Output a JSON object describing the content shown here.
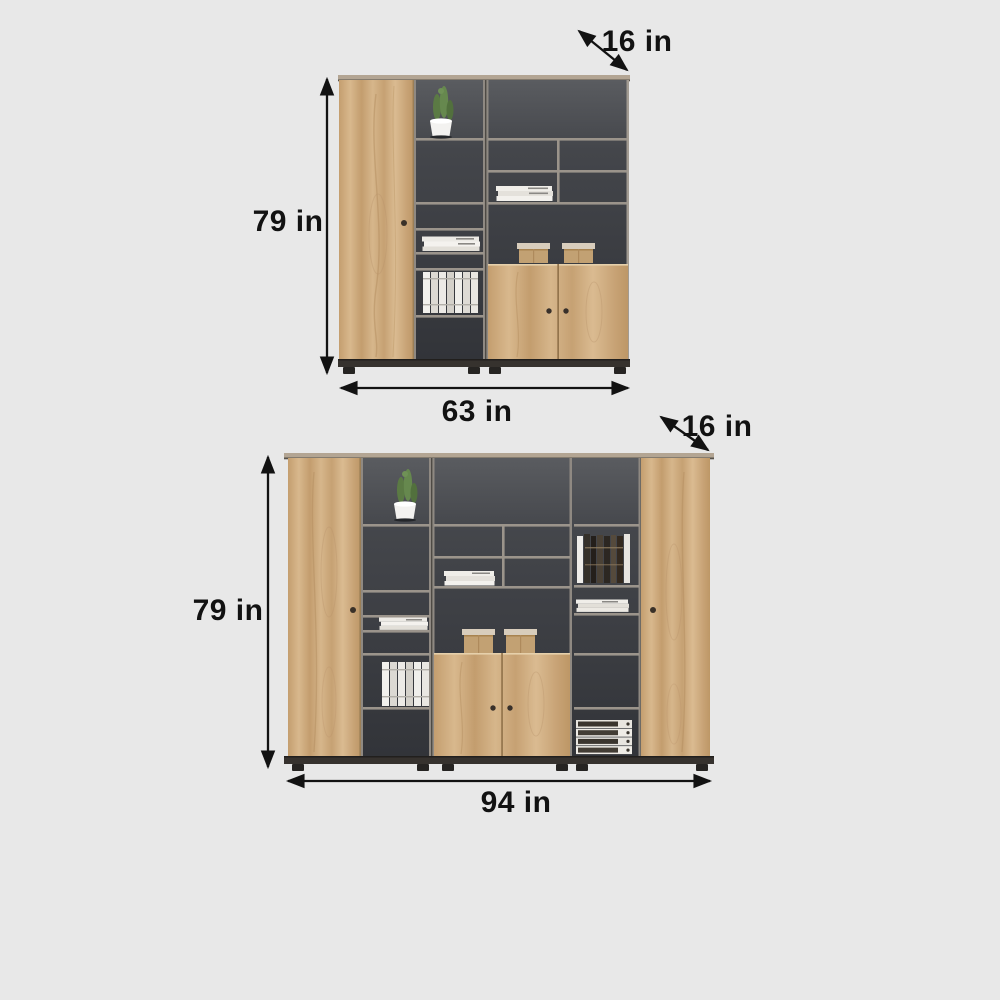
{
  "page": {
    "background_color": "#e8e8e8",
    "label_color": "#121212",
    "wood_color": "#cda87b",
    "panel_dark_color": "#3a3d42",
    "shelf_edge_color": "#9b948b"
  },
  "diagrams": [
    {
      "name": "cabinet-63-inch",
      "depth_label": "16 in",
      "height_label": "79 in",
      "width_label": "63 in"
    },
    {
      "name": "cabinet-94-inch",
      "depth_label": "16 in",
      "height_label": "79 in",
      "width_label": "94 in"
    }
  ]
}
